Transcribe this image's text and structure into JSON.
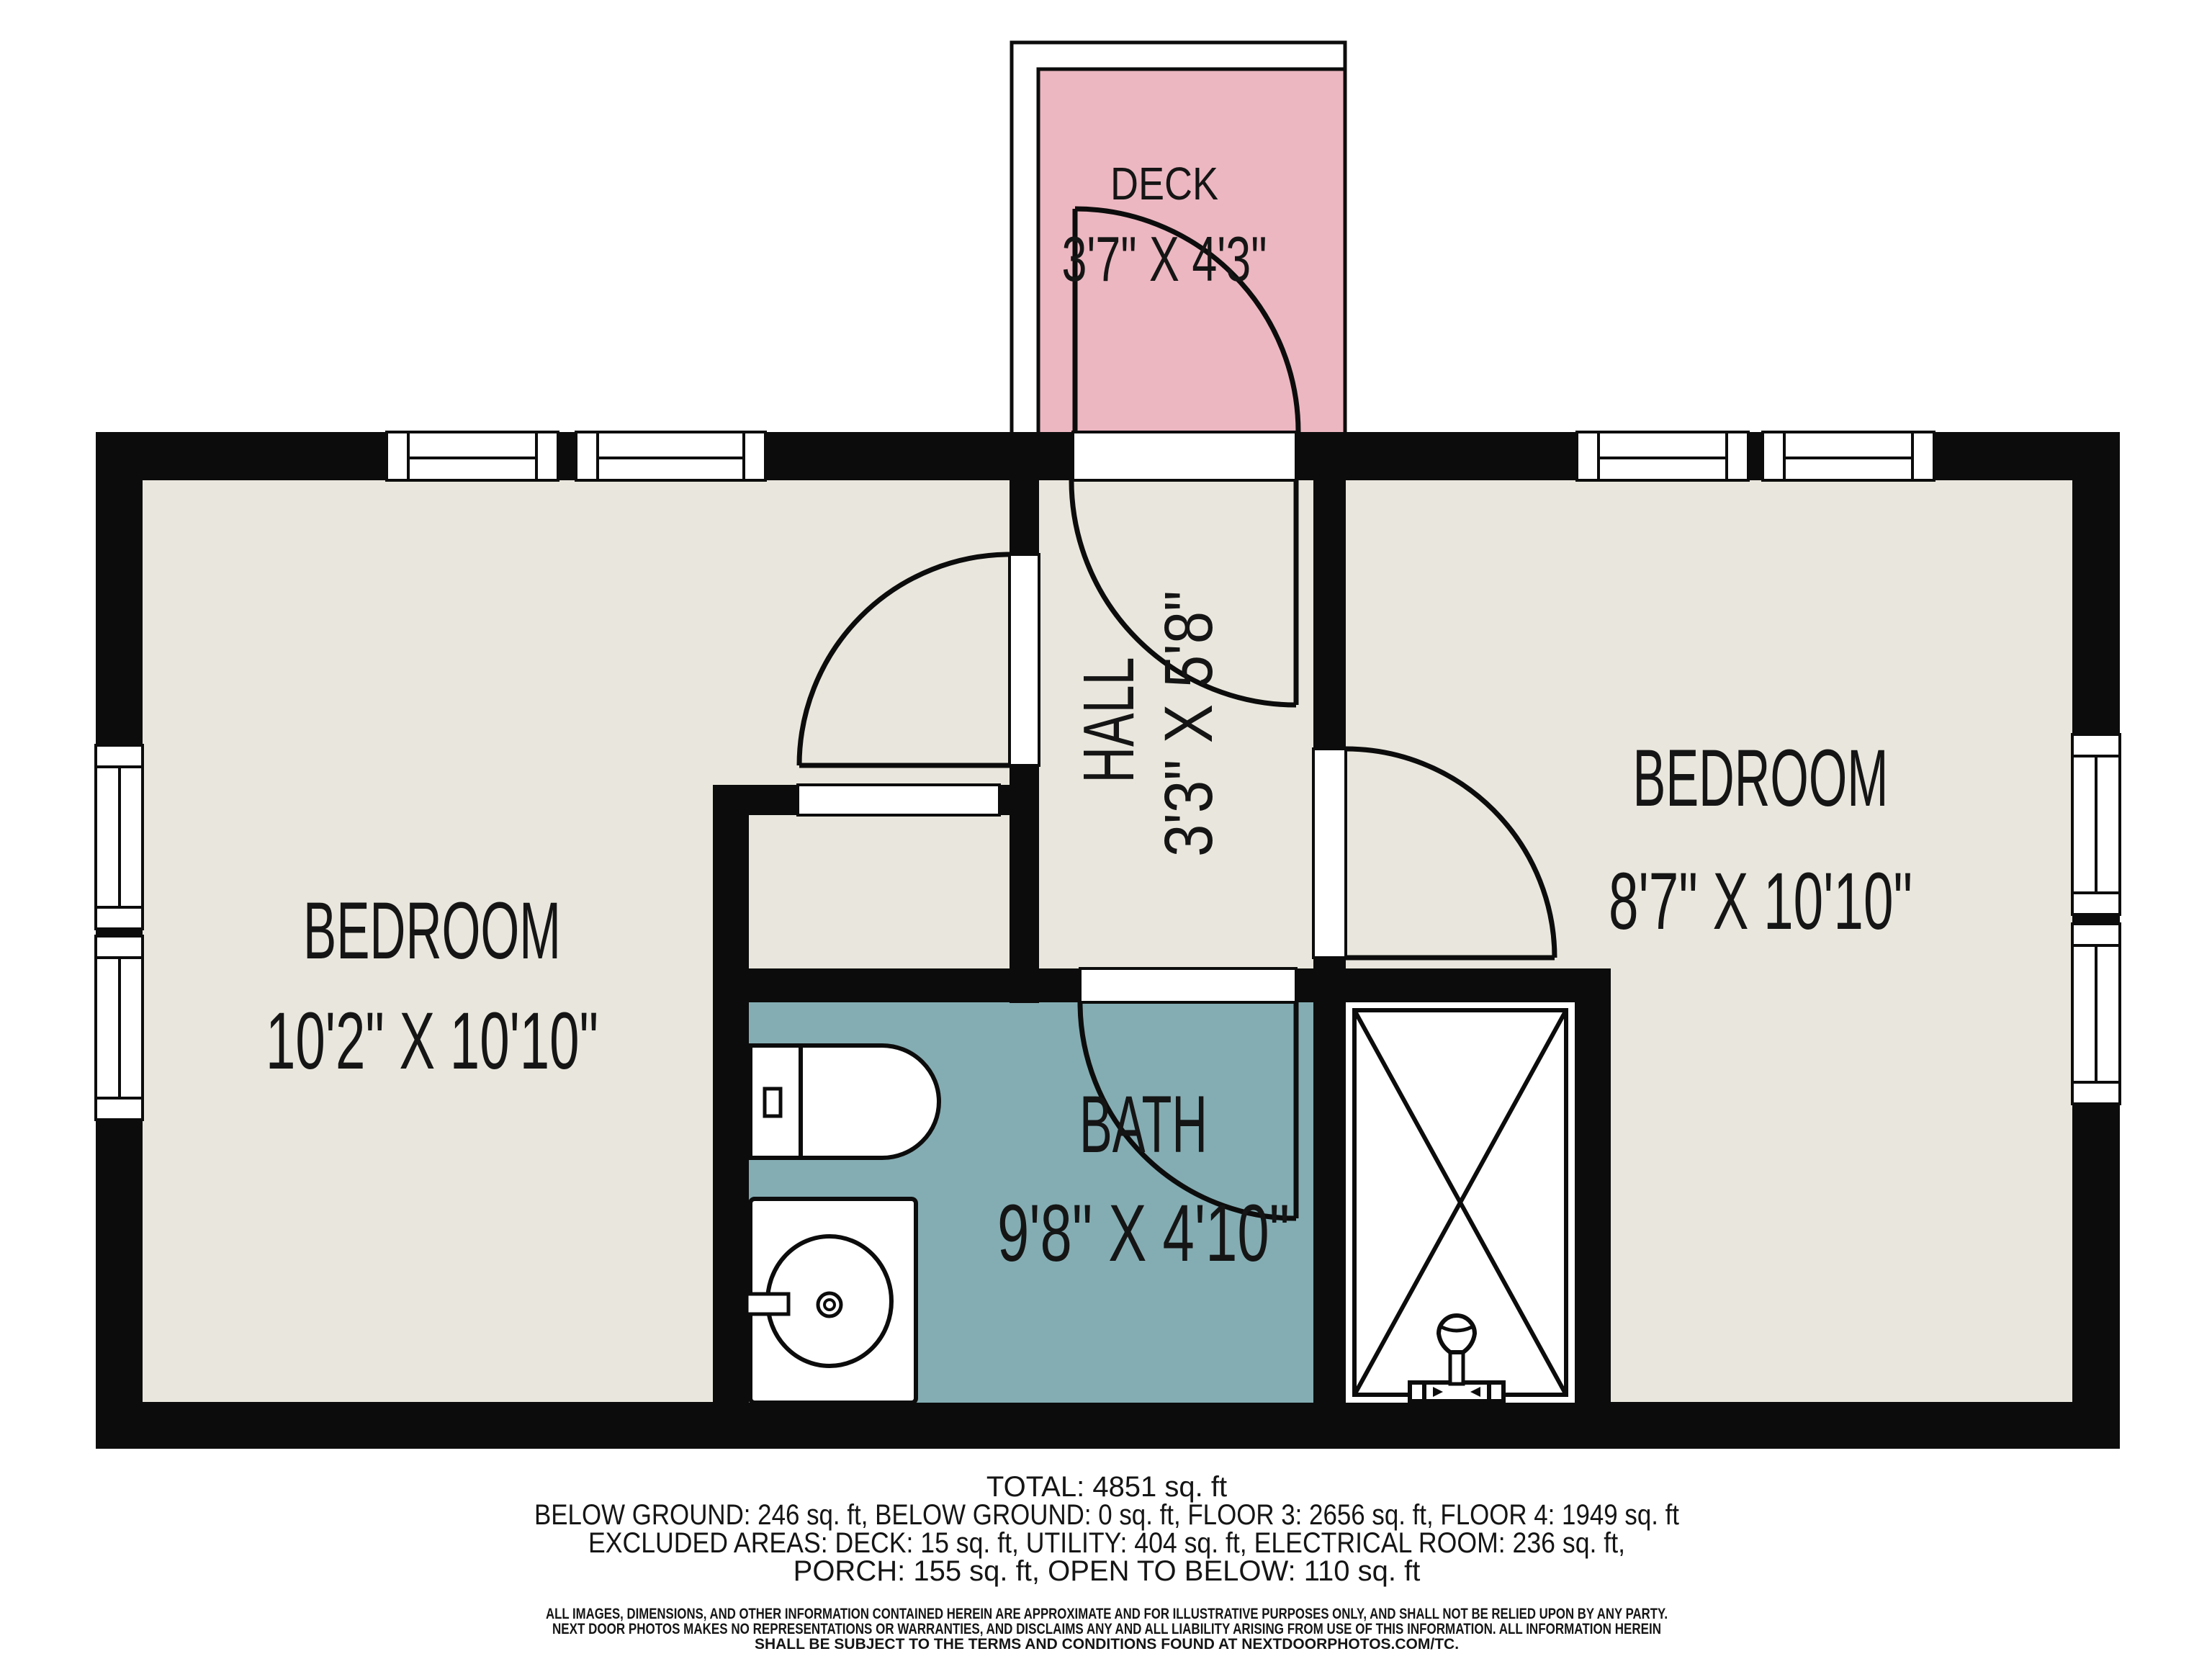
{
  "colors": {
    "wall": "#0c0c0c",
    "floor": "#e9e7dd",
    "deck": "#ecb7c1",
    "bath": "#84adb3",
    "fixture_fill": "#ffffff"
  },
  "rooms": {
    "deck": {
      "name": "DECK",
      "dims": "3'7\" X 4'3\""
    },
    "hall": {
      "name": "HALL",
      "dims": "3'3\" X 5'8\""
    },
    "bedroom_left": {
      "name": "BEDROOM",
      "dims": "10'2\" X 10'10\""
    },
    "bedroom_right": {
      "name": "BEDROOM",
      "dims": "8'7\" X 10'10\""
    },
    "bath": {
      "name": "BATH",
      "dims": "9'8\" X 4'10\""
    }
  },
  "summary": {
    "line1": "TOTAL: 4851 sq. ft",
    "line2": "BELOW GROUND: 246 sq. ft, BELOW GROUND: 0 sq. ft, FLOOR 3: 2656 sq. ft, FLOOR 4: 1949 sq. ft",
    "line3": "EXCLUDED AREAS: DECK: 15 sq. ft, UTILITY: 404 sq. ft, ELECTRICAL ROOM: 236 sq. ft,",
    "line4": "PORCH: 155 sq. ft, OPEN TO BELOW: 110 sq. ft"
  },
  "disclaimer": {
    "line1": "ALL IMAGES, DIMENSIONS, AND OTHER INFORMATION CONTAINED HEREIN ARE APPROXIMATE AND FOR ILLUSTRATIVE PURPOSES ONLY, AND SHALL NOT BE RELIED UPON BY ANY PARTY.",
    "line2": "NEXT DOOR PHOTOS MAKES NO REPRESENTATIONS OR WARRANTIES, AND DISCLAIMS ANY AND ALL LIABILITY ARISING FROM USE OF THIS INFORMATION. ALL INFORMATION HEREIN",
    "line3": "SHALL BE SUBJECT TO THE TERMS AND CONDITIONS FOUND AT NEXTDOORPHOTOS.COM/TC."
  }
}
